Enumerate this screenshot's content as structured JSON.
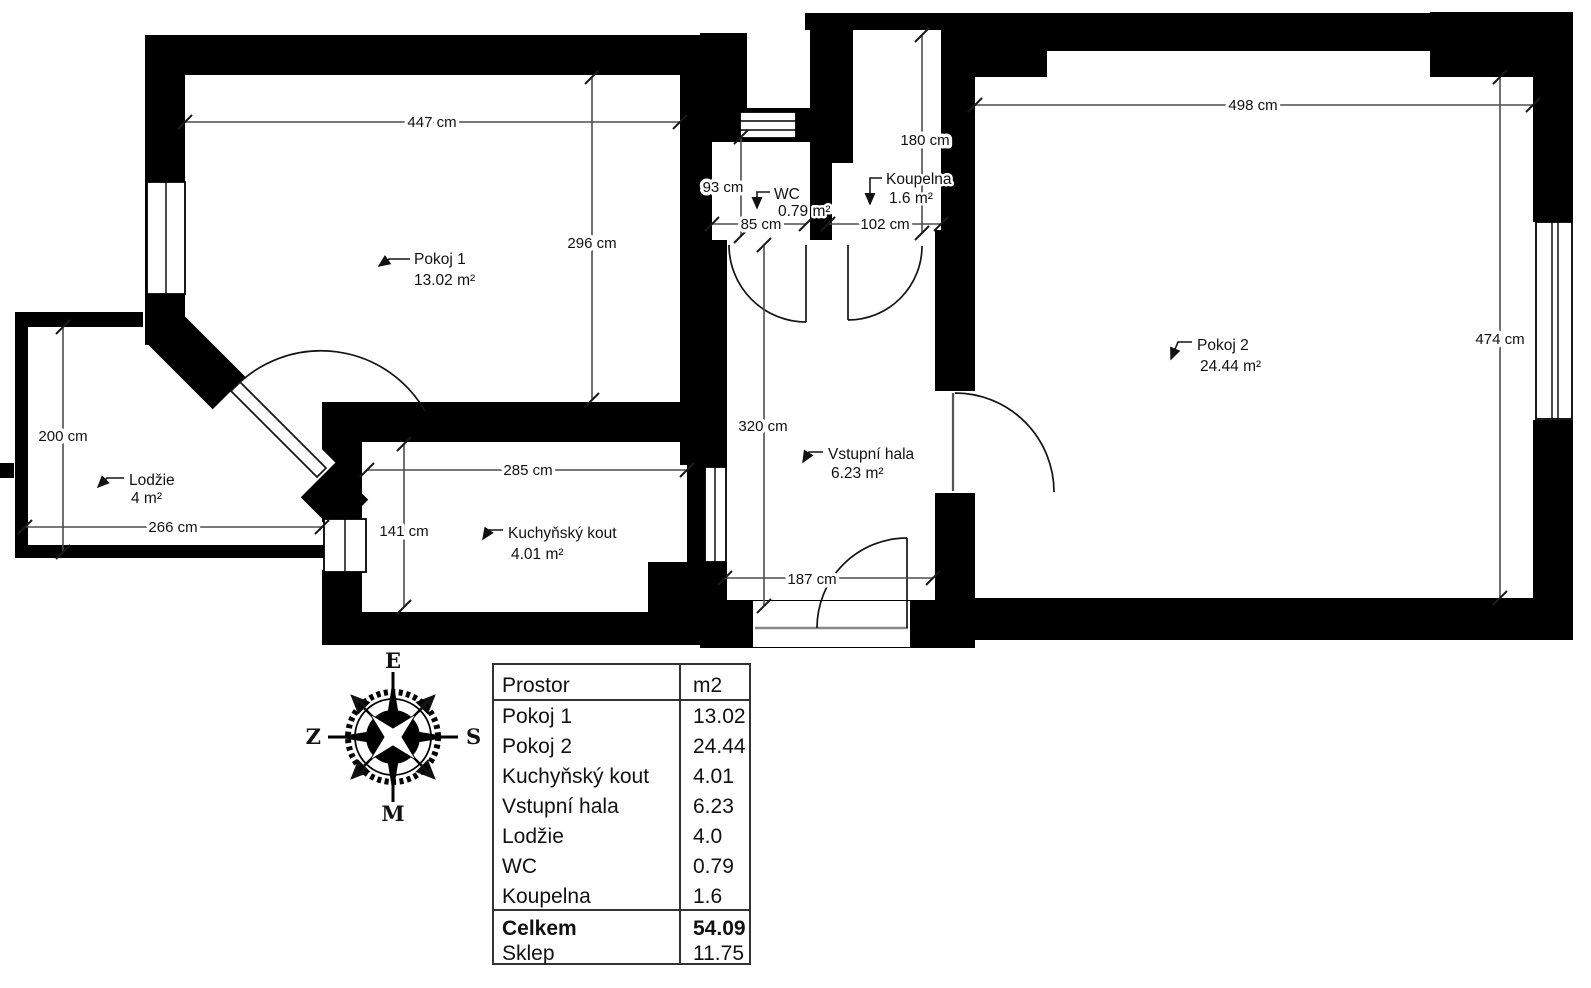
{
  "rooms": {
    "pokoj1": {
      "name": "Pokoj 1",
      "area": "13.02 m²"
    },
    "pokoj2": {
      "name": "Pokoj 2",
      "area": "24.44 m²"
    },
    "kuchynsky_kout": {
      "name": "Kuchyňský kout",
      "area": "4.01 m²"
    },
    "vstupni_hala": {
      "name": "Vstupní hala",
      "area": "6.23 m²"
    },
    "lodzie": {
      "name": "Lodžie",
      "area": "4 m²"
    },
    "wc": {
      "name": "WC",
      "area": "0.79 m²"
    },
    "koupelna": {
      "name": "Koupelna",
      "area": "1.6 m²"
    }
  },
  "dimensions": {
    "pokoj1_width": "447 cm",
    "pokoj1_height": "296 cm",
    "wc_height": "93 cm",
    "wc_width": "85 cm",
    "koupelna_width": "102 cm",
    "koupelna_height": "180 cm",
    "pokoj2_width": "498 cm",
    "pokoj2_height": "474 cm",
    "hala_height": "320 cm",
    "hala_width": "187 cm",
    "kuchyn_width": "285 cm",
    "kuchyn_height": "141 cm",
    "lodzie_width": "266 cm",
    "lodzie_height": "200 cm"
  },
  "compass": {
    "top": "E",
    "right": "S",
    "bottom": "M",
    "left": "Z"
  },
  "table": {
    "header": {
      "col1": "Prostor",
      "col2": "m2"
    },
    "rows": [
      {
        "name": "Pokoj 1",
        "value": "13.02"
      },
      {
        "name": "Pokoj 2",
        "value": "24.44"
      },
      {
        "name": "Kuchyňský kout",
        "value": "4.01"
      },
      {
        "name": "Vstupní hala",
        "value": "6.23"
      },
      {
        "name": "Lodžie",
        "value": "4.0"
      },
      {
        "name": "WC",
        "value": "0.79"
      },
      {
        "name": "Koupelna",
        "value": "1.6"
      }
    ],
    "total": {
      "name": "Celkem",
      "value": "54.09"
    },
    "basement": {
      "name": "Sklep",
      "value": "11.75"
    }
  },
  "colors": {
    "wall": "#000000",
    "background": "#ffffff",
    "dimension_line": "#4d4d4d",
    "threshold": "#888888"
  }
}
